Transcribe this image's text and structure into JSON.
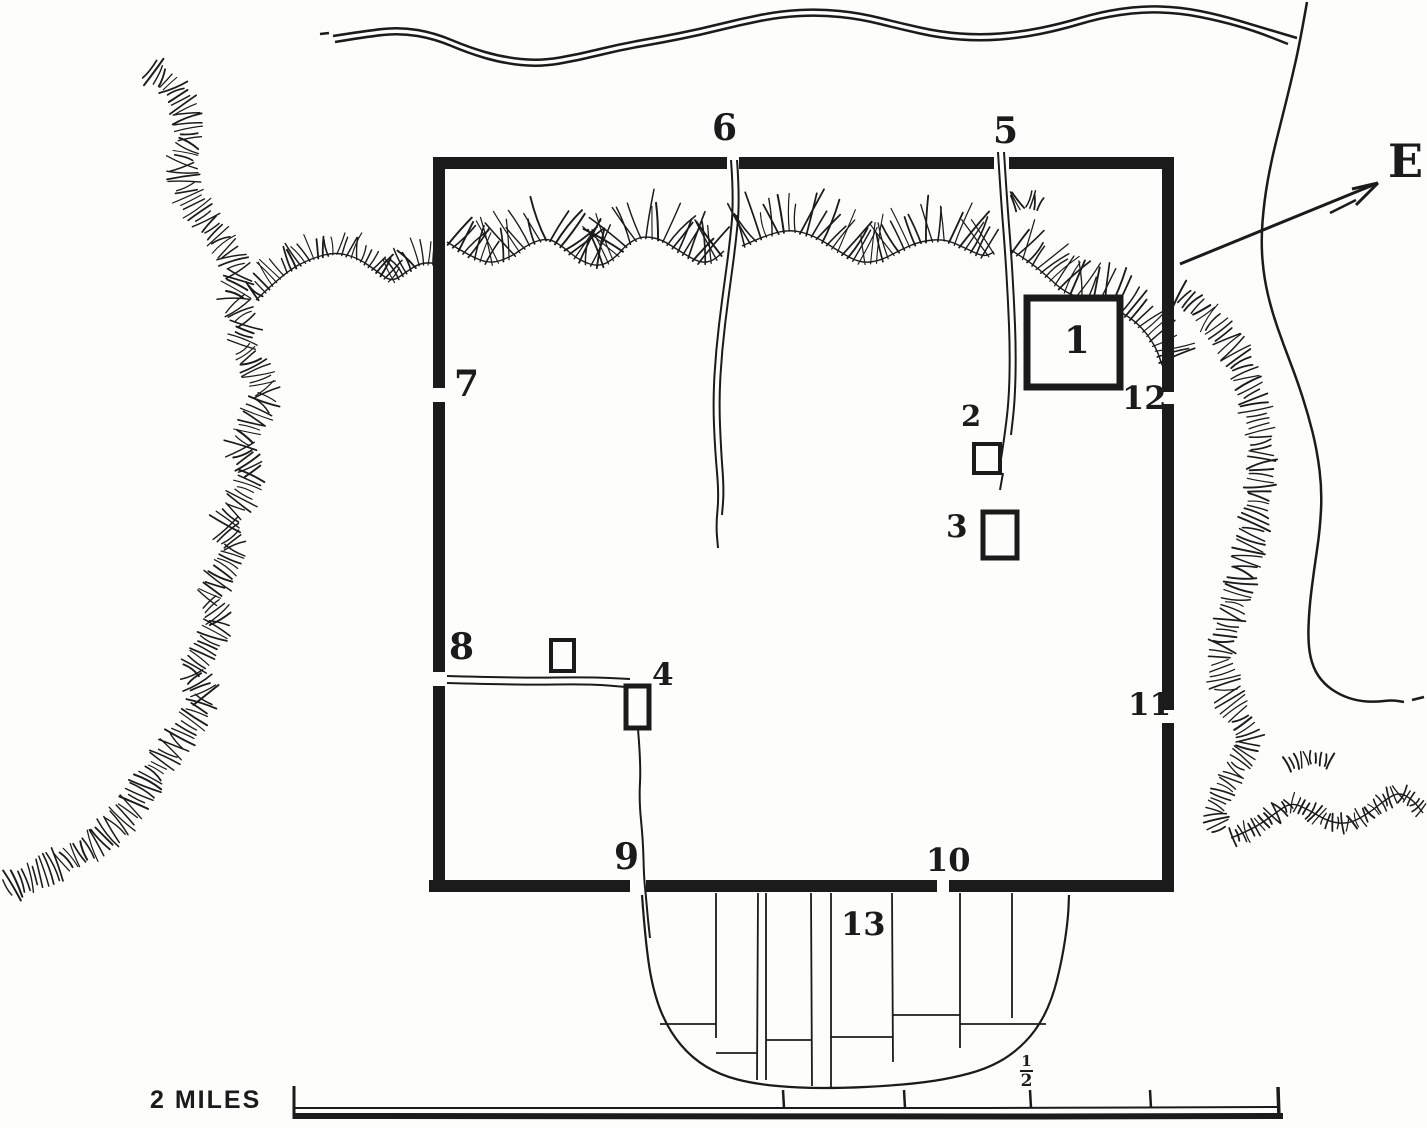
{
  "map": {
    "labels": {
      "g1": "1",
      "g2": "2",
      "g3": "3",
      "g4": "4",
      "g5": "5",
      "g6": "6",
      "g7": "7",
      "g8": "8",
      "g9": "9",
      "g10": "10",
      "g11": "11",
      "g12": "12",
      "g13": "13"
    },
    "compass": {
      "east_label": "E"
    },
    "scale_bar": {
      "label": "2 MILES",
      "fraction": {
        "num": "1",
        "den": "2"
      }
    },
    "colors": {
      "ink": "#1b1b1b",
      "paper": "#fdfdfb"
    }
  }
}
